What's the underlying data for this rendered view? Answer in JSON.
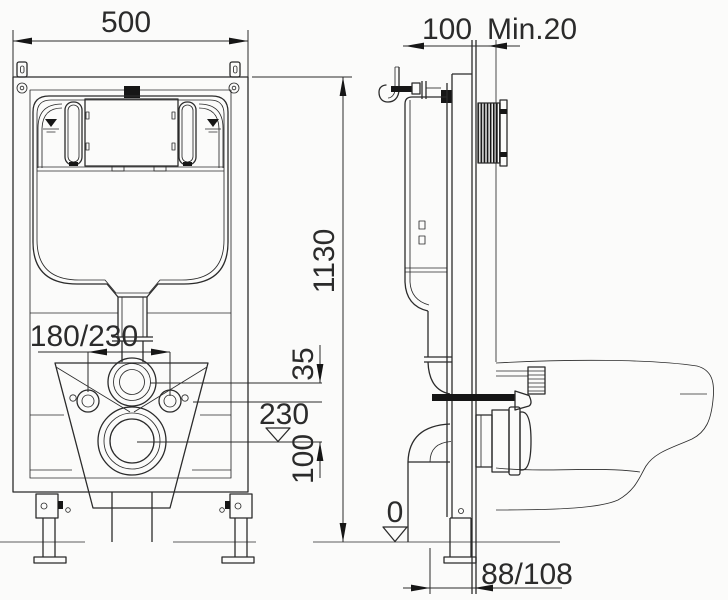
{
  "drawing": {
    "kind": "technical-installation-drawing",
    "views": [
      "front",
      "side"
    ],
    "labels": {
      "width": "500",
      "depth": "100",
      "wall_min": "Min.20",
      "height": "1130",
      "bolt_spacing": "180/230",
      "flush_offset": "35",
      "outlet_level": "230",
      "outlet_to_bolt": "100",
      "floor_level": "0",
      "outlet_wall_distance": "88/108"
    },
    "colors": {
      "line": "#2b2b2b",
      "bg": "#fbfbfa",
      "fill": "#161616"
    }
  }
}
